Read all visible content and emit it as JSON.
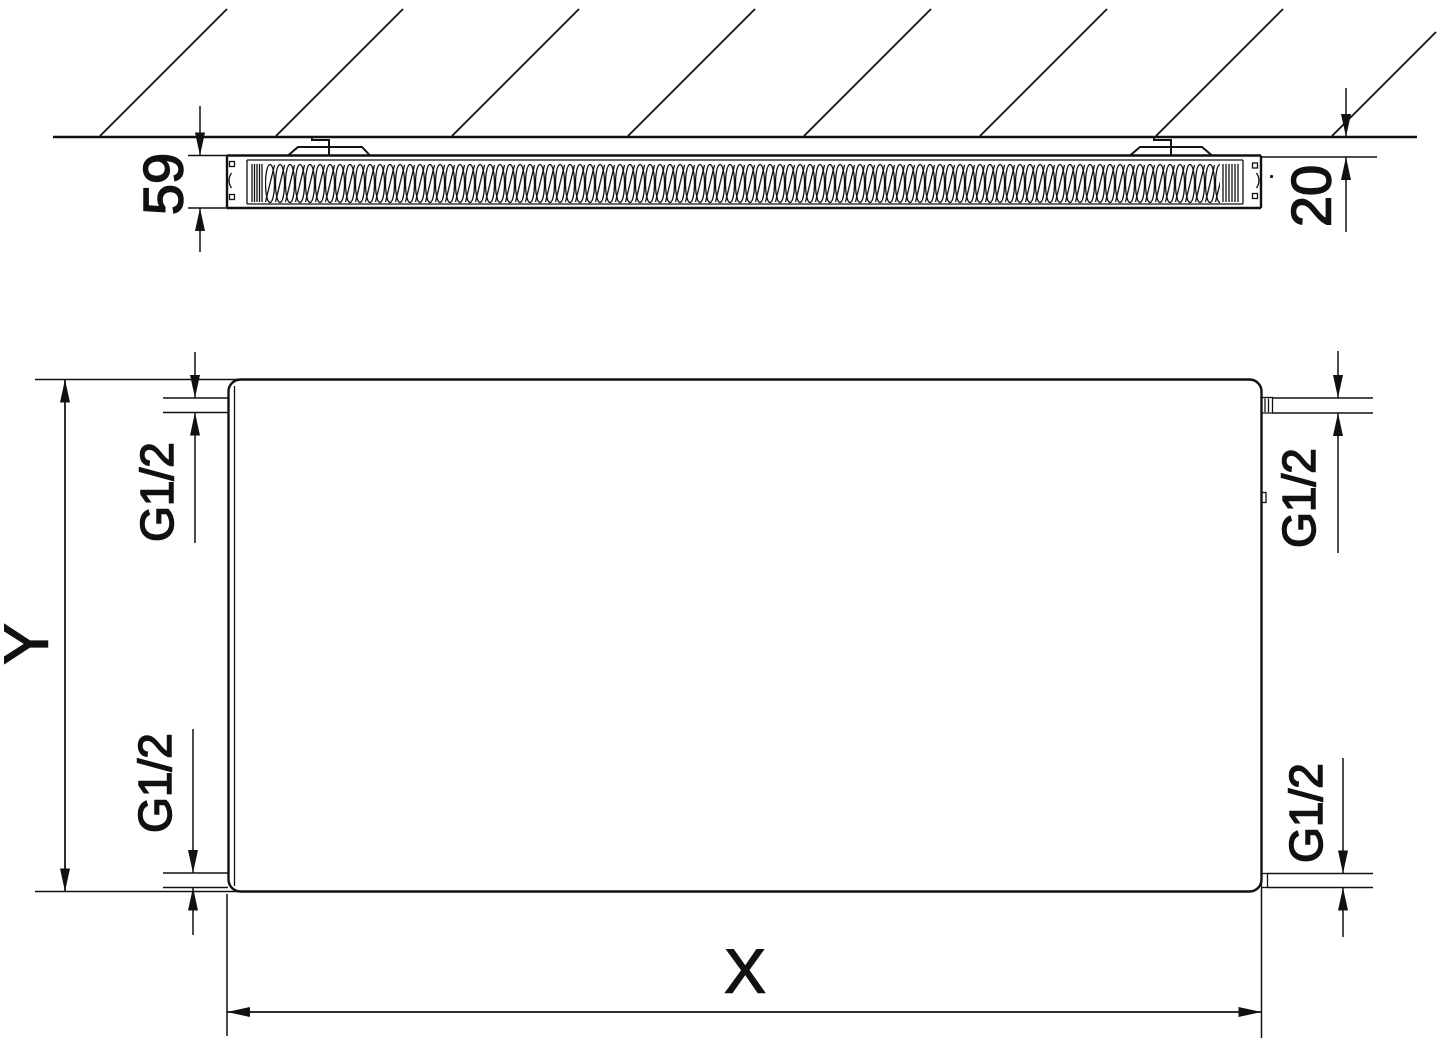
{
  "colors": {
    "line": "#111111",
    "background": "#ffffff"
  },
  "top_view": {
    "depth": "59",
    "wall_distance": "20"
  },
  "front_view": {
    "height": "Y",
    "width": "X",
    "connections": {
      "top_left": "G1/2",
      "bottom_left": "G1/2",
      "top_right": "G1/2",
      "bottom_right": "G1/2"
    }
  }
}
